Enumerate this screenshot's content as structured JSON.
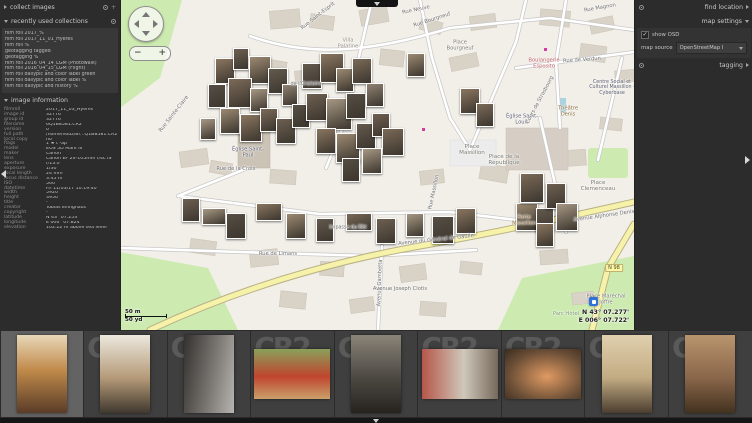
{
  "left_panel": {
    "collect_images": {
      "title": "collect images"
    },
    "recent_collections": {
      "title": "recently used collections",
      "items": [
        "film roll 2017_%",
        "film roll 2017_11_01_Hyères",
        "film roll %",
        "geotagging tagged",
        "geotagging %",
        "film roll 2016_04_14_LGM (Photowalk)",
        "film roll 2016_04_15_LGM (Flight)",
        "film roll dailypic and color label green",
        "film roll dailypic and color label %",
        "film roll dailypic and history %"
      ]
    },
    "image_information": {
      "title": "image information",
      "rows": [
        {
          "label": "filmroll",
          "value": "2017_11_03_Hyères"
        },
        {
          "label": "image id",
          "value": "32776"
        },
        {
          "label": "group id",
          "value": "32776"
        },
        {
          "label": "filename",
          "value": "6Q1B8581.CR2"
        },
        {
          "label": "version",
          "value": "0"
        },
        {
          "label": "full path",
          "value": "/home/houz/Bi…Q1B8581.CR2"
        },
        {
          "label": "local copy",
          "value": "no"
        },
        {
          "label": "flags",
          "value": "1 ★ t -ap"
        },
        {
          "label": "model",
          "value": "EOS 5D Mark III"
        },
        {
          "label": "maker",
          "value": "Canon"
        },
        {
          "label": "lens",
          "value": "Canon EF 24-105mm f/4L IS"
        },
        {
          "label": "aperture",
          "value": "f/13.0"
        },
        {
          "label": "exposure",
          "value": "1/30"
        },
        {
          "label": "focal length",
          "value": "24 mm"
        },
        {
          "label": "focus distance",
          "value": "3.45 m"
        },
        {
          "label": "ISO",
          "value": "500"
        },
        {
          "label": "datetime",
          "value": "Fri 11/03/17 10:19:40"
        },
        {
          "label": "width",
          "value": "5920"
        },
        {
          "label": "height",
          "value": "3950"
        },
        {
          "label": "title",
          "value": "-"
        },
        {
          "label": "creator",
          "value": "Tobias Ellinghaus"
        },
        {
          "label": "copyright",
          "value": "-"
        },
        {
          "label": "latitude",
          "value": "N 43° 07.253'"
        },
        {
          "label": "longitude",
          "value": "E 006° 07.824'"
        },
        {
          "label": "elevation",
          "value": "102.22 m above sea level"
        }
      ]
    }
  },
  "right_panel": {
    "find_location": {
      "title": "find location"
    },
    "map_settings": {
      "title": "map settings",
      "show_osd_label": "show OSD",
      "show_osd_checked": true,
      "check_glyph": "✓",
      "map_source_label": "map source",
      "map_source_value": "OpenStreetMap I"
    },
    "tagging": {
      "title": "tagging"
    }
  },
  "map": {
    "scale_m": "50 m",
    "scale_yd": "50 yd",
    "osd_lat": "N 43° 07.277'",
    "osd_lon": "E 006° 07.722'",
    "zoom_out_label": "−",
    "zoom_in_label": "+",
    "labels": [
      {
        "t": "Rue Neuve",
        "x": 296,
        "y": 10,
        "r": -12,
        "s": 5.2,
        "c": "#6f6f6f"
      },
      {
        "t": "Rue Saint-Esprit",
        "x": 198,
        "y": 16,
        "r": -38,
        "s": 5.2,
        "c": "#6f6f6f"
      },
      {
        "t": "Rue Bourgneuf",
        "x": 312,
        "y": 20,
        "r": -18,
        "s": 5.2,
        "c": "#6f6f6f"
      },
      {
        "t": "Place Bourgneuf",
        "x": 340,
        "y": 46,
        "r": 0,
        "s": 5.2,
        "c": "#7a7a72",
        "w": 32
      },
      {
        "t": "Villa Palatine",
        "x": 228,
        "y": 44,
        "r": 0,
        "s": 5.2,
        "c": "#97938a",
        "w": 30
      },
      {
        "t": "Rue Magnon",
        "x": 480,
        "y": 8,
        "r": -10,
        "s": 5.2,
        "c": "#6f6f6f"
      },
      {
        "t": "Rue Sainte-Claire",
        "x": 54,
        "y": 114,
        "r": -52,
        "s": 5.2,
        "c": "#6f6f6f"
      },
      {
        "t": "Église Saint-Paul",
        "x": 128,
        "y": 153,
        "r": 0,
        "s": 5.2,
        "c": "#5c5c6e",
        "w": 38
      },
      {
        "t": "Rue de la Croix",
        "x": 116,
        "y": 169,
        "r": 0,
        "s": 5.2,
        "c": "#6f6f6f"
      },
      {
        "t": "de l'Oratoire",
        "x": 186,
        "y": 84,
        "r": 0,
        "s": 5,
        "c": "#6f6f6f"
      },
      {
        "t": "Place Massillon",
        "x": 352,
        "y": 150,
        "r": 0,
        "s": 5.6,
        "c": "#7a7a72",
        "w": 38
      },
      {
        "t": "Église Saint-Louis",
        "x": 402,
        "y": 120,
        "r": 0,
        "s": 5.2,
        "c": "#5c5c6e",
        "w": 42
      },
      {
        "t": "Place de la République",
        "x": 384,
        "y": 160,
        "r": 0,
        "s": 5.6,
        "c": "#7a7a72",
        "w": 50
      },
      {
        "t": "Place Clemenceau",
        "x": 478,
        "y": 186,
        "r": 0,
        "s": 5.6,
        "c": "#7a7a72",
        "w": 44
      },
      {
        "t": "Théâtre Denis",
        "x": 448,
        "y": 112,
        "r": 0,
        "s": 5.2,
        "c": "#8a6d3b",
        "w": 32
      },
      {
        "t": "Boulangerie Esposito",
        "x": 424,
        "y": 64,
        "r": 0,
        "s": 5.2,
        "c": "#c0616b",
        "w": 42
      },
      {
        "t": "Rue de Verdun",
        "x": 462,
        "y": 60,
        "r": -4,
        "s": 5.2,
        "c": "#6f6f6f"
      },
      {
        "t": "Cours de Strasbourg",
        "x": 420,
        "y": 100,
        "r": -62,
        "s": 5.2,
        "c": "#6f6f6f"
      },
      {
        "t": "Centre Social et Culturel Massillon - Cyberbase",
        "x": 492,
        "y": 88,
        "r": 0,
        "s": 4.8,
        "c": "#5c5c6e",
        "w": 48
      },
      {
        "t": "Rue Massillon",
        "x": 314,
        "y": 192,
        "r": -78,
        "s": 5.2,
        "c": "#6f6f6f"
      },
      {
        "t": "Porte Massillon",
        "x": 404,
        "y": 221,
        "r": 0,
        "s": 5.2,
        "c": "#8a6d3b",
        "w": 36
      },
      {
        "t": "Avenue Alphonse Denis",
        "x": 484,
        "y": 216,
        "r": -8,
        "s": 5.2,
        "c": "#6f6f6f"
      },
      {
        "t": "Avenue du Général de Gaulle",
        "x": 316,
        "y": 240,
        "r": -6,
        "s": 5.2,
        "c": "#6f6f6f"
      },
      {
        "t": "Avenue Gambetta",
        "x": 260,
        "y": 283,
        "r": -88,
        "s": 5.2,
        "c": "#6f6f6f"
      },
      {
        "t": "Avenue Joseph Clotis",
        "x": 280,
        "y": 289,
        "r": 0,
        "s": 5.2,
        "c": "#6f6f6f"
      },
      {
        "t": "Place Maréchal Joffre",
        "x": 486,
        "y": 300,
        "r": 0,
        "s": 5.2,
        "c": "#7a7a72",
        "w": 42
      },
      {
        "t": "Parc Hôtel",
        "x": 446,
        "y": 315,
        "r": 0,
        "s": 5.2,
        "c": "#7a9a6a",
        "w": 28
      },
      {
        "t": "Rue de Limans",
        "x": 158,
        "y": 254,
        "r": 0,
        "s": 5.2,
        "c": "#6f6f6f"
      },
      {
        "t": "Impasse du Bât",
        "x": 228,
        "y": 228,
        "r": 0,
        "s": 4.8,
        "c": "#6f6f6f"
      },
      {
        "t": "N 98",
        "x": 494,
        "y": 268,
        "r": 0,
        "s": 5,
        "c": "#4a4a2e",
        "badge": true
      }
    ],
    "photo_palette": [
      "#8a7660",
      "#6e6052",
      "#9c8a72",
      "#564e44",
      "#7b6a58",
      "#a79884",
      "#645a4e",
      "#8f8273"
    ],
    "photos": [
      [
        95,
        58,
        20,
        26,
        0
      ],
      [
        113,
        48,
        16,
        22,
        1
      ],
      [
        129,
        56,
        22,
        28,
        2
      ],
      [
        88,
        84,
        18,
        24,
        3
      ],
      [
        108,
        78,
        24,
        30,
        4
      ],
      [
        130,
        88,
        18,
        24,
        5
      ],
      [
        148,
        68,
        20,
        26,
        6
      ],
      [
        162,
        84,
        16,
        22,
        7
      ],
      [
        100,
        108,
        20,
        26,
        2
      ],
      [
        120,
        114,
        22,
        28,
        0
      ],
      [
        140,
        108,
        18,
        24,
        4
      ],
      [
        156,
        118,
        20,
        26,
        1
      ],
      [
        80,
        118,
        16,
        22,
        5
      ],
      [
        172,
        104,
        18,
        24,
        3
      ],
      [
        182,
        63,
        20,
        26,
        6
      ],
      [
        200,
        53,
        24,
        30,
        0
      ],
      [
        216,
        68,
        18,
        24,
        2
      ],
      [
        232,
        58,
        20,
        26,
        4
      ],
      [
        186,
        93,
        22,
        28,
        1
      ],
      [
        206,
        98,
        26,
        32,
        5
      ],
      [
        226,
        93,
        20,
        26,
        3
      ],
      [
        246,
        83,
        18,
        24,
        7
      ],
      [
        196,
        128,
        20,
        26,
        0
      ],
      [
        216,
        133,
        24,
        30,
        2
      ],
      [
        236,
        123,
        20,
        26,
        6
      ],
      [
        252,
        113,
        18,
        24,
        1
      ],
      [
        262,
        128,
        22,
        28,
        4
      ],
      [
        242,
        148,
        20,
        26,
        5
      ],
      [
        222,
        158,
        18,
        24,
        3
      ],
      [
        287,
        53,
        18,
        24,
        2
      ],
      [
        340,
        88,
        20,
        26,
        0
      ],
      [
        356,
        103,
        18,
        24,
        4
      ],
      [
        62,
        198,
        18,
        24,
        1
      ],
      [
        82,
        208,
        24,
        17,
        5
      ],
      [
        106,
        213,
        20,
        26,
        3
      ],
      [
        136,
        203,
        26,
        18,
        0
      ],
      [
        166,
        213,
        20,
        26,
        2
      ],
      [
        196,
        218,
        18,
        24,
        6
      ],
      [
        226,
        213,
        26,
        18,
        4
      ],
      [
        256,
        218,
        20,
        26,
        1
      ],
      [
        286,
        213,
        18,
        24,
        5
      ],
      [
        312,
        216,
        22,
        28,
        3
      ],
      [
        336,
        208,
        20,
        26,
        0
      ],
      [
        396,
        203,
        22,
        28,
        2
      ],
      [
        416,
        208,
        18,
        24,
        6
      ],
      [
        400,
        173,
        24,
        30,
        4
      ],
      [
        426,
        183,
        20,
        26,
        1
      ],
      [
        436,
        203,
        22,
        28,
        5
      ],
      [
        416,
        223,
        18,
        24,
        0
      ]
    ]
  },
  "filmstrip": {
    "watermark": "CR2",
    "items": [
      {
        "name": "narrow-street-yellow-buildings",
        "orientation": "portrait",
        "selected": true,
        "wm": false,
        "g": "linear-gradient(180deg,#e8d7b8 0%,#c08a4a 45%,#5a3c28 100%)"
      },
      {
        "name": "street-with-blue-banner",
        "orientation": "portrait",
        "selected": false,
        "wm": true,
        "g": "linear-gradient(180deg,#ece8de 0%,#b59a78 55%,#40382e 100%)"
      },
      {
        "name": "wet-alley-shops",
        "orientation": "portrait",
        "selected": false,
        "wm": true,
        "g": "linear-gradient(100deg,#34312e 0%,#7a7672 55%,#b8b6b2 100%)"
      },
      {
        "name": "market-produce-stall",
        "orientation": "landscape",
        "selected": false,
        "wm": true,
        "g": "linear-gradient(180deg,#8aa05a 0%,#c0452f 55%,#caa06a 100%)"
      },
      {
        "name": "street-people-chalkboard",
        "orientation": "portrait",
        "selected": false,
        "wm": true,
        "g": "linear-gradient(180deg,#8a8478 0%,#4c4842 55%,#26221e 100%)"
      },
      {
        "name": "street-red-house",
        "orientation": "landscape",
        "selected": false,
        "wm": true,
        "g": "linear-gradient(90deg,#b5564a 0%,#cfc8ba 55%,#76695c 100%)"
      },
      {
        "name": "basket-of-shrimp",
        "orientation": "landscape",
        "selected": false,
        "wm": true,
        "g": "radial-gradient(ellipse at 55% 55%,#e09a62 0%,#6a4e36 65%,#3a2c1e 100%)"
      },
      {
        "name": "tall-building-archway",
        "orientation": "portrait",
        "selected": false,
        "wm": true,
        "g": "linear-gradient(180deg,#e0d0ae 0%,#c2ab82 55%,#4c3e30 100%)"
      },
      {
        "name": "stone-arch-entrance",
        "orientation": "portrait",
        "selected": false,
        "wm": true,
        "g": "linear-gradient(180deg,#b8946e 0%,#8a664a 55%,#42321f 100%)"
      }
    ]
  }
}
